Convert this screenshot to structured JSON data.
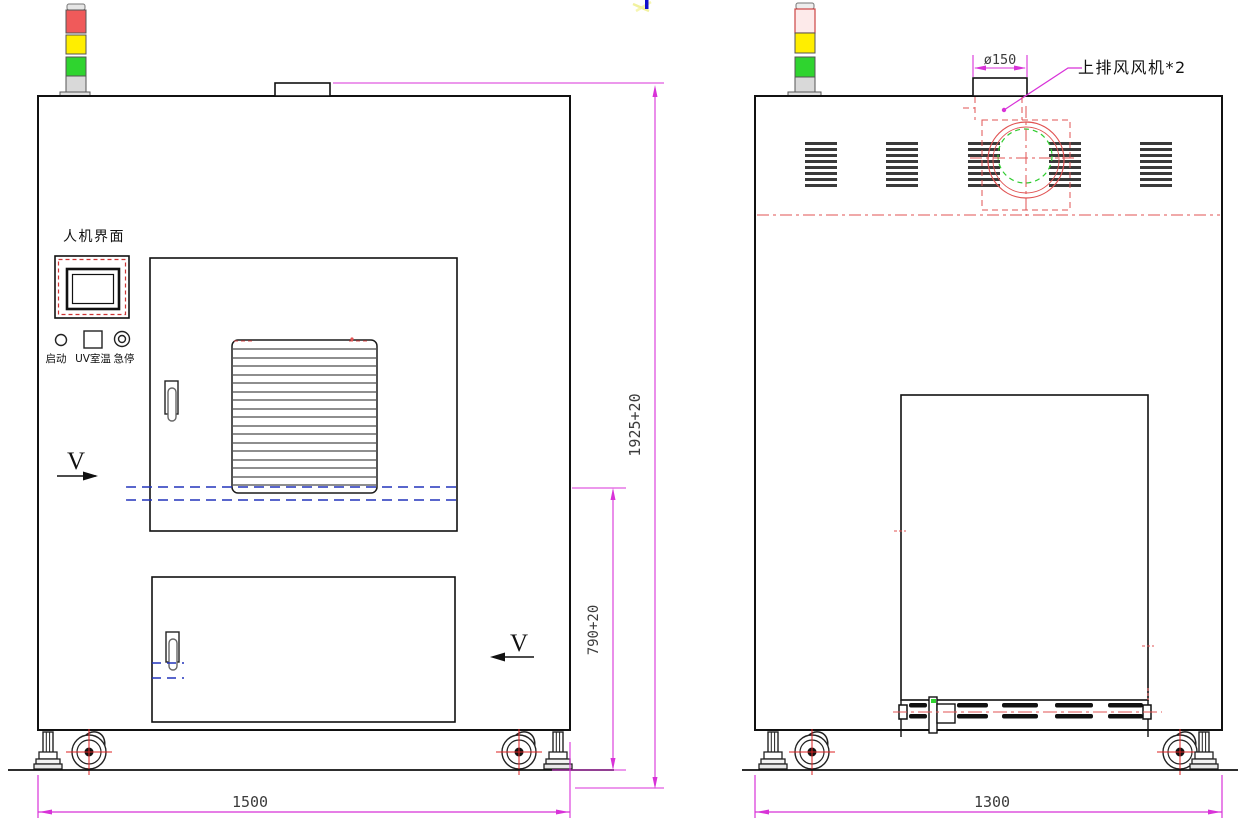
{
  "front_view": {
    "hmi_label": "人机界面",
    "buttons": {
      "start": "启动",
      "uv_temp": "UV室温",
      "estop": "急停"
    },
    "section_marker_left": "V",
    "section_marker_right": "V",
    "dim_width": "1500",
    "dim_height": "1925+20",
    "dim_opening_height": "790+20"
  },
  "side_view": {
    "dim_width": "1300",
    "dim_fan_diameter": "ø150",
    "fan_callout": "上排风风机*2"
  },
  "colors": {
    "dimension_magenta": "#d832d8",
    "detail_red": "#e05353",
    "detail_green": "#2ecc2e",
    "hidden_blue": "#2233bb",
    "tower_red": "#f05a5a",
    "tower_yellow": "#ffee00",
    "tower_green": "#2fd42f"
  }
}
